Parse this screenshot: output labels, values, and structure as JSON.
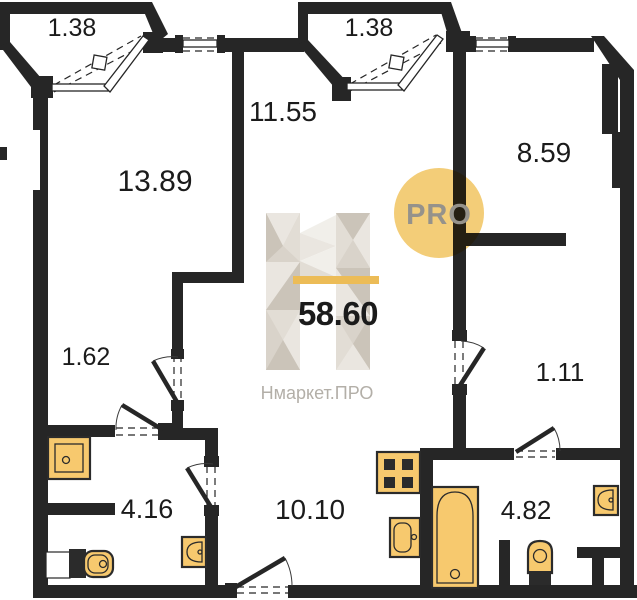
{
  "plan": {
    "type": "apartment-floor-plan",
    "total_area": "58.60",
    "rooms": {
      "balcony_left": {
        "area": "1.38"
      },
      "balcony_mid": {
        "area": "1.38"
      },
      "hall_center": {
        "area": "11.55"
      },
      "room_left": {
        "area": "13.89"
      },
      "room_right": {
        "area": "8.59"
      },
      "corridor_left": {
        "area": "1.62"
      },
      "corridor_right": {
        "area": "1.11"
      },
      "bathroom_left": {
        "area": "4.16"
      },
      "kitchen": {
        "area": "10.10"
      },
      "bathroom_right": {
        "area": "4.82"
      }
    }
  },
  "watermark": {
    "total_area": "58.60",
    "brand": "Нмаркет.ПРО",
    "badge": "PRO"
  },
  "colors": {
    "wall": "#262626",
    "label_text": "#1b1b1b",
    "fixture_fill": "#F7C96E",
    "fixture_stroke": "#2b2b2b",
    "accent_bar": "#ECBC57",
    "badge_fill": "#F3CD78",
    "badge_text": "#95928B",
    "brand_text": "#B3AFA8",
    "facet_1": "#CBC4B9",
    "facet_2": "#D9D3CA",
    "facet_3": "#E2DDD5",
    "facet_4": "#EAE6E0",
    "facet_5": "#F1EFEA"
  }
}
